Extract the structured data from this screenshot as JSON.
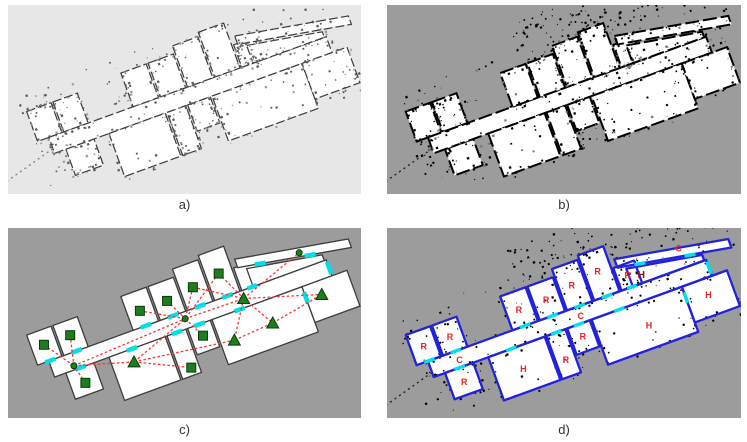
{
  "figure": {
    "description": "Four-stage building map processing figure: occupancy grid, thresholded map, topological graph, room segmentation"
  },
  "panels": [
    {
      "id": "a",
      "caption": "a)",
      "bg": "#e7e7e7",
      "style": "grid-light"
    },
    {
      "id": "b",
      "caption": "b)",
      "bg": "#9c9c9c",
      "style": "grid-dark"
    },
    {
      "id": "c",
      "caption": "c)",
      "bg": "#9c9c9c",
      "style": "topology"
    },
    {
      "id": "d",
      "caption": "d)",
      "bg": "#9c9c9c",
      "style": "segmented"
    }
  ],
  "map": {
    "rotation": -20,
    "offset": {
      "x": -10,
      "y": 75
    },
    "colors": {
      "panel_light_bg": "#e7e7e7",
      "panel_gray_bg": "#9c9c9c",
      "room_white": "#ffffff",
      "wall_black": "#000000",
      "wall_gray": "#3a3a3a",
      "segment_blue": "#2222dd",
      "door_cyan": "#00e0ea",
      "node_green": "#1e7d1e",
      "node_green_dark": "#0a3a0a",
      "edge_red": "#ff3333",
      "label_red": "#e82222",
      "label_dark_red": "#8b1818",
      "caption_gray": "#333333"
    },
    "label_letters": {
      "room": "R",
      "hall": "H",
      "corridor": "C"
    },
    "rooms": [
      {
        "id": "room-left-1",
        "type": "R",
        "x": 16,
        "y": 40,
        "w": 26,
        "h": 32,
        "label": [
          29,
          57
        ]
      },
      {
        "id": "room-left-2",
        "type": "R",
        "x": 44,
        "y": 40,
        "w": 26,
        "h": 32,
        "label": [
          57,
          57
        ]
      },
      {
        "id": "room-left-3",
        "type": "R",
        "x": 40,
        "y": 89,
        "w": 30,
        "h": 28,
        "label": [
          55,
          104
        ]
      },
      {
        "id": "corridor-main",
        "type": "C",
        "x": 28,
        "y": 72,
        "w": 296,
        "h": 17,
        "labels": [
          [
            58,
            82
          ],
          [
            187,
            82
          ]
        ]
      },
      {
        "id": "room-top-1",
        "type": "R",
        "x": 118,
        "y": 36,
        "w": 27,
        "h": 36,
        "label": [
          131,
          55
        ]
      },
      {
        "id": "room-top-2",
        "type": "R",
        "x": 147,
        "y": 36,
        "w": 27,
        "h": 36,
        "label": [
          160,
          55
        ]
      },
      {
        "id": "room-top-3",
        "type": "R",
        "x": 176,
        "y": 28,
        "w": 27,
        "h": 44,
        "label": [
          189,
          50
        ]
      },
      {
        "id": "room-top-4",
        "type": "R",
        "x": 205,
        "y": 24,
        "w": 27,
        "h": 48,
        "label": [
          218,
          46
        ]
      },
      {
        "id": "room-top-5",
        "type": "R",
        "x": 234,
        "y": 48,
        "w": 22,
        "h": 24,
        "label": [
          245,
          60
        ]
      },
      {
        "id": "hall-1",
        "type": "H",
        "x": 86,
        "y": 89,
        "w": 60,
        "h": 46,
        "label": [
          115,
          112
        ]
      },
      {
        "id": "room-bottom-narrow",
        "type": "R",
        "x": 148,
        "y": 89,
        "w": 20,
        "h": 46,
        "label": [
          158,
          118
        ]
      },
      {
        "id": "room-bottom-small",
        "type": "R",
        "x": 170,
        "y": 89,
        "w": 24,
        "h": 28,
        "label": [
          182,
          102
        ]
      },
      {
        "id": "hall-2",
        "type": "H",
        "x": 196,
        "y": 89,
        "w": 96,
        "h": 48,
        "label": [
          248,
          114
        ]
      },
      {
        "id": "hall-3",
        "type": "H",
        "x": 292,
        "y": 89,
        "w": 48,
        "h": 38,
        "label": [
          314,
          106
        ]
      },
      {
        "id": "hall-upper-right",
        "type": "H",
        "pts": [
          [
            246,
            53
          ],
          [
            322,
            66
          ],
          [
            322,
            72
          ],
          [
            246,
            72
          ]
        ],
        "label": null
      }
    ],
    "thin_corridor": {
      "id": "corridor-thin",
      "type": "C",
      "pts": [
        [
          238,
          40
        ],
        [
          352,
          60
        ],
        [
          352,
          69
        ],
        [
          238,
          49
        ]
      ],
      "label": [
        302,
        52
      ]
    },
    "bold_label": {
      "text": "H",
      "pos": [
        258,
        64
      ]
    },
    "tail": {
      "from": [
        28,
        84
      ],
      "to": [
        -26,
        99
      ]
    },
    "doors": [
      [
        [
          126,
          72
        ],
        [
          137,
          72
        ]
      ],
      [
        [
          155,
          72
        ],
        [
          166,
          72
        ]
      ],
      [
        [
          184,
          72
        ],
        [
          195,
          72
        ]
      ],
      [
        [
          213,
          72
        ],
        [
          224,
          72
        ]
      ],
      [
        [
          240,
          72
        ],
        [
          250,
          72
        ]
      ],
      [
        [
          105,
          89
        ],
        [
          116,
          89
        ]
      ],
      [
        [
          153,
          89
        ],
        [
          164,
          89
        ]
      ],
      [
        [
          177,
          89
        ],
        [
          188,
          89
        ]
      ],
      [
        [
          220,
          89
        ],
        [
          231,
          89
        ]
      ],
      [
        [
          24,
          72
        ],
        [
          35,
          72
        ]
      ],
      [
        [
          52,
          72
        ],
        [
          63,
          72
        ]
      ],
      [
        [
          50,
          89
        ],
        [
          61,
          89
        ]
      ],
      [
        [
          255,
          52
        ],
        [
          266,
          54
        ]
      ],
      [
        [
          305,
          61
        ],
        [
          316,
          63
        ]
      ],
      [
        [
          292,
          95
        ],
        [
          292,
          106
        ]
      ],
      [
        [
          324,
          74
        ],
        [
          324,
          87
        ]
      ]
    ],
    "nodes": [
      {
        "shape": "square",
        "pos": [
          131,
          56
        ]
      },
      {
        "shape": "square",
        "pos": [
          160,
          56
        ]
      },
      {
        "shape": "square",
        "pos": [
          189,
          52
        ]
      },
      {
        "shape": "square",
        "pos": [
          218,
          48
        ]
      },
      {
        "shape": "square",
        "pos": [
          29,
          55
        ]
      },
      {
        "shape": "square",
        "pos": [
          57,
          55
        ]
      },
      {
        "shape": "square",
        "pos": [
          55,
          105
        ]
      },
      {
        "shape": "square",
        "pos": [
          160,
          127
        ]
      },
      {
        "shape": "square",
        "pos": [
          182,
          101
        ]
      },
      {
        "shape": "triangle",
        "pos": [
          108,
          102
        ]
      },
      {
        "shape": "triangle",
        "pos": [
          210,
          116
        ]
      },
      {
        "shape": "triangle",
        "pos": [
          252,
          113
        ]
      },
      {
        "shape": "triangle",
        "pos": [
          308,
          103
        ]
      },
      {
        "shape": "triangle",
        "pos": [
          233,
          80
        ]
      },
      {
        "shape": "dot",
        "pos": [
          50,
          85
        ]
      },
      {
        "shape": "dot",
        "pos": [
          171,
          79
        ]
      },
      {
        "shape": "dot",
        "pos": [
          301,
          56
        ]
      }
    ],
    "edges": [
      [
        0,
        15
      ],
      [
        1,
        15
      ],
      [
        2,
        15
      ],
      [
        2,
        13
      ],
      [
        3,
        13
      ],
      [
        3,
        15
      ],
      [
        4,
        14
      ],
      [
        5,
        14
      ],
      [
        6,
        14
      ],
      [
        14,
        9
      ],
      [
        14,
        15
      ],
      [
        9,
        15
      ],
      [
        9,
        7
      ],
      [
        9,
        10
      ],
      [
        15,
        8
      ],
      [
        15,
        13
      ],
      [
        13,
        10
      ],
      [
        13,
        11
      ],
      [
        13,
        16
      ],
      [
        13,
        12
      ],
      [
        11,
        12
      ],
      [
        10,
        11
      ]
    ]
  }
}
